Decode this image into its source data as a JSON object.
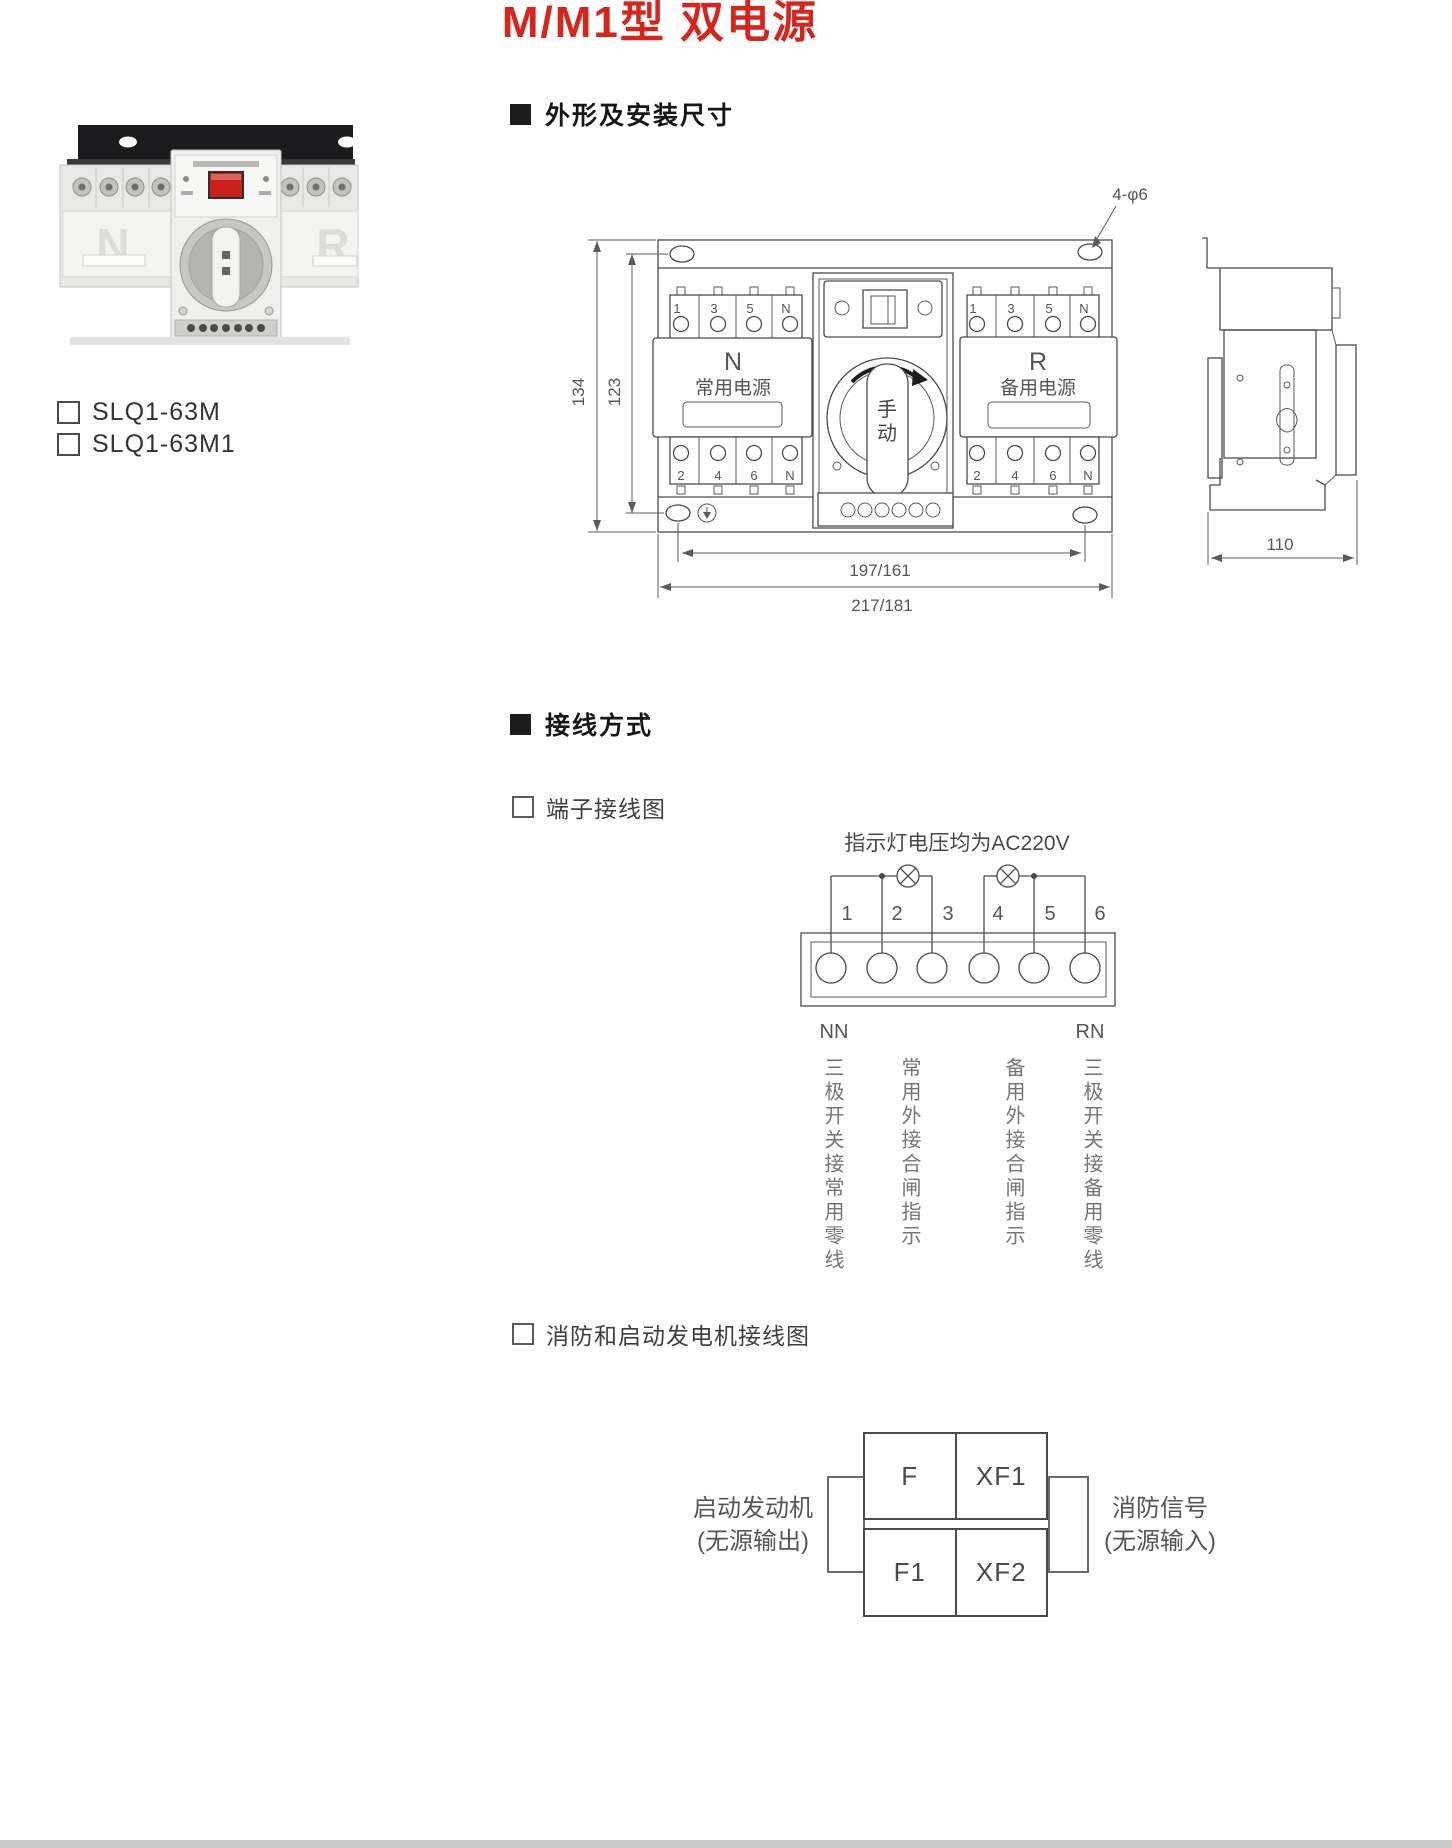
{
  "title": "M/M1型 双电源",
  "models": {
    "m": "SLQ1-63M",
    "m1": "SLQ1-63M1"
  },
  "sections": {
    "dimensions": "外形及安装尺寸",
    "wiring": "接线方式"
  },
  "subsections": {
    "terminal": "端子接线图",
    "fire": "消防和启动发电机接线图"
  },
  "photo": {
    "left_marking": "N",
    "right_marking": "R"
  },
  "front_view": {
    "hole_note": "4-φ6",
    "dim_h_outer": "134",
    "dim_h_inner": "123",
    "dim_w_inner": "197/161",
    "dim_w_outer": "217/181",
    "top_terms": [
      "1",
      "3",
      "5",
      "N"
    ],
    "bot_terms": [
      "2",
      "4",
      "6",
      "N"
    ],
    "left_name": "N",
    "left_label": "常用电源",
    "right_name": "R",
    "right_label": "备用电源",
    "knob_char1": "手",
    "knob_char2": "动"
  },
  "side_view": {
    "dim_w": "110"
  },
  "terminal_diagram": {
    "note": "指示灯电压均为AC220V",
    "terminals": [
      "1",
      "2",
      "3",
      "4",
      "5",
      "6"
    ],
    "nn": "NN",
    "rn": "RN",
    "labels": [
      "三极开关接常用零线",
      "常用外接合闸指示",
      "备用外接合闸指示",
      "三极开关接备用零线"
    ]
  },
  "fire_diagram": {
    "tl": "F",
    "tr": "XF1",
    "bl": "F1",
    "br": "XF2",
    "left_caption1": "启动发动机",
    "left_caption2": "(无源输出)",
    "right_caption1": "消防信号",
    "right_caption2": "(无源输入)"
  }
}
